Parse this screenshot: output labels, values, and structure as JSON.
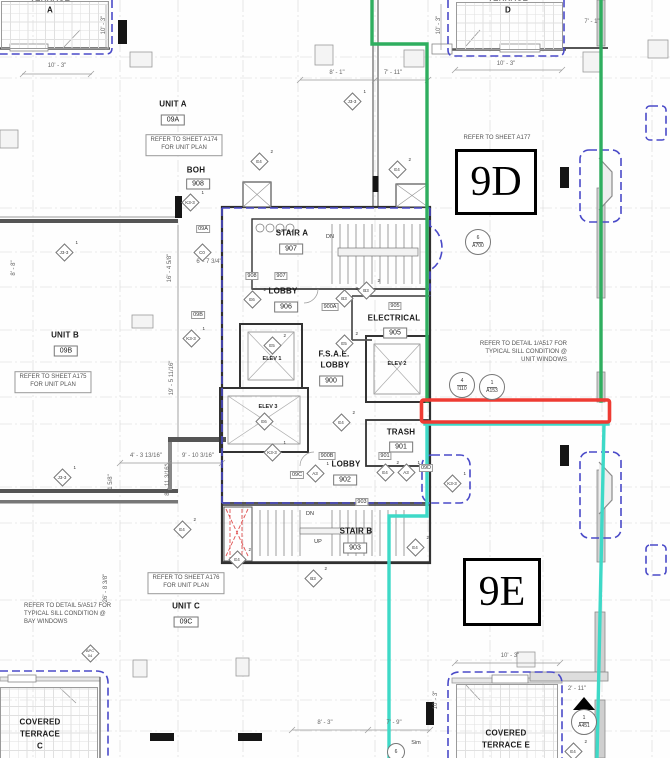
{
  "areas": {
    "d_label": "9D",
    "e_label": "9E"
  },
  "colors": {
    "boundary_green": "#2fae5f",
    "boundary_teal": "#3ed9c7",
    "highlight_red": "#ee3b33",
    "demising_blue": "#4a4ac8"
  },
  "rooms": {
    "terrace_a": {
      "line1": "TERRACE",
      "line2": "A"
    },
    "terrace_d": {
      "line1": "TERRACE",
      "line2": "D"
    },
    "unit_a": {
      "name": "UNIT A",
      "tag": "09A"
    },
    "boh": {
      "name": "BOH",
      "tag": "908"
    },
    "stair_a": {
      "name": "STAIR A",
      "tag": "907"
    },
    "lobby_906": {
      "name": "LOBBY",
      "tag": "906"
    },
    "electrical": {
      "name": "ELECTRICAL",
      "tag": "905"
    },
    "fsae_lobby": {
      "line1": "F.S.A.E.",
      "line2": "LOBBY",
      "tag": "900"
    },
    "elev_1": {
      "name": "ELEV 1",
      "diamond": "E5",
      "sup": "2"
    },
    "elev_2": {
      "name": "ELEV 2"
    },
    "elev_3": {
      "name": "ELEV 3",
      "diamond": "E6"
    },
    "trash": {
      "name": "TRASH",
      "tag": "901"
    },
    "lobby_902": {
      "name": "LOBBY",
      "tag": "902"
    },
    "stair_b": {
      "name": "STAIR B",
      "tag": "903"
    },
    "unit_b": {
      "name": "UNIT B",
      "tag": "09B"
    },
    "unit_c": {
      "name": "UNIT C",
      "tag": "09C"
    },
    "covered_terrace_c": {
      "line1": "COVERED",
      "line2": "TERRACE",
      "line3": "C"
    },
    "covered_terrace_e": {
      "line1": "COVERED",
      "line2": "TERRACE E"
    }
  },
  "notes": {
    "a174": {
      "line1": "REFER TO SHEET A174",
      "line2": "FOR UNIT PLAN"
    },
    "a175": {
      "line1": "REFER TO SHEET A175",
      "line2": "FOR UNIT PLAN"
    },
    "a176": {
      "line1": "REFER TO SHEET A176",
      "line2": "FOR UNIT PLAN"
    },
    "a177": {
      "line1": "REFER TO SHEET A177"
    },
    "detail_1_a517": {
      "line1": "REFER TO DETAIL 1/A517 FOR",
      "line2": "TYPICAL SILL CONDITION @",
      "line3": "UNIT WINDOWS"
    },
    "detail_5_a517": {
      "line1": "REFER TO DETAIL 5/A517 FOR",
      "line2": "TYPICAL SILL CONDITION @",
      "line3": "BAY WINDOWS"
    }
  },
  "stairs": {
    "dn_a": "DN",
    "dn_b": "DN",
    "up_b": "UP"
  },
  "door_tags": {
    "d_09a": "09A",
    "d_09b": "09B",
    "d_09c": "09C",
    "d_09d": "09D",
    "d_908": "908",
    "d_907": "907",
    "d_900a": "900A",
    "d_900b": "900B",
    "d_901": "901",
    "d_903": "903",
    "d_905": "905"
  },
  "dims": {
    "ta_w": "10' - 3\"",
    "ta_h": "10' - 3\"",
    "td_w": "10' - 3\"",
    "td_h": "10' - 3\"",
    "td_r": "7' - 1\"",
    "top_1": "8' - 1\"",
    "top_2": "7' - 11\"",
    "left_1": "8' - 8\"",
    "left_2": "26' - 8 3/8\"",
    "core_1": "16' - 4 5/8\"",
    "core_2": "6' - 7 3/4\"",
    "core_3": "19' - 5 11/16\"",
    "core_4": "4' - 3 13/16\"",
    "core_5": "9' - 10 3/16\"",
    "core_6": "8' - 11 3/16\"",
    "core_7": "1 5/8\"",
    "bot_1": "8' - 3\"",
    "bot_2": "7' - 9\"",
    "te_w": "10' - 3\"",
    "te_h": "10' - 3\"",
    "te_r": "2' - 11\""
  },
  "markers": {
    "circle_a700": {
      "num": "6",
      "ref": "A700"
    },
    "circle_i110": {
      "num": "4",
      "ref": "I110"
    },
    "circle_a153": {
      "num": "1",
      "ref": "A153"
    },
    "section_a451": {
      "num": "1",
      "ref": "A451"
    },
    "circle_sim": {
      "num": "6",
      "label": "Sim"
    },
    "diamonds": [
      {
        "label": "J3-3",
        "sup": "1"
      },
      {
        "label": "E4",
        "sup": "2"
      },
      {
        "label": "E4",
        "sup": "2"
      },
      {
        "label": "K3-3",
        "sup": "1"
      },
      {
        "label": "C0",
        "sup": ""
      },
      {
        "label": "J3-3",
        "sup": "1"
      },
      {
        "label": "E6",
        "sup": "2"
      },
      {
        "label": "B3",
        "sup": "2"
      },
      {
        "label": "B3",
        "sup": "2"
      },
      {
        "label": "K3-3",
        "sup": "1"
      },
      {
        "label": "E5",
        "sup": "2"
      },
      {
        "label": "K3-3",
        "sup": "1"
      },
      {
        "label": "E4",
        "sup": "2"
      },
      {
        "label": "A3",
        "sup": "1"
      },
      {
        "label": "E4",
        "sup": "2"
      },
      {
        "label": "A3",
        "sup": "1"
      },
      {
        "label": "K3-3",
        "sup": "1"
      },
      {
        "label": "E4",
        "sup": "2"
      },
      {
        "label": "E4",
        "sup": "2"
      },
      {
        "label": "B3",
        "sup": "2"
      },
      {
        "label": "E4",
        "sup": "2"
      },
      {
        "label": "J3-3",
        "sup": "1"
      },
      {
        "label": "APC",
        "sup": "04"
      },
      {
        "label": "E4",
        "sup": "2"
      }
    ]
  }
}
